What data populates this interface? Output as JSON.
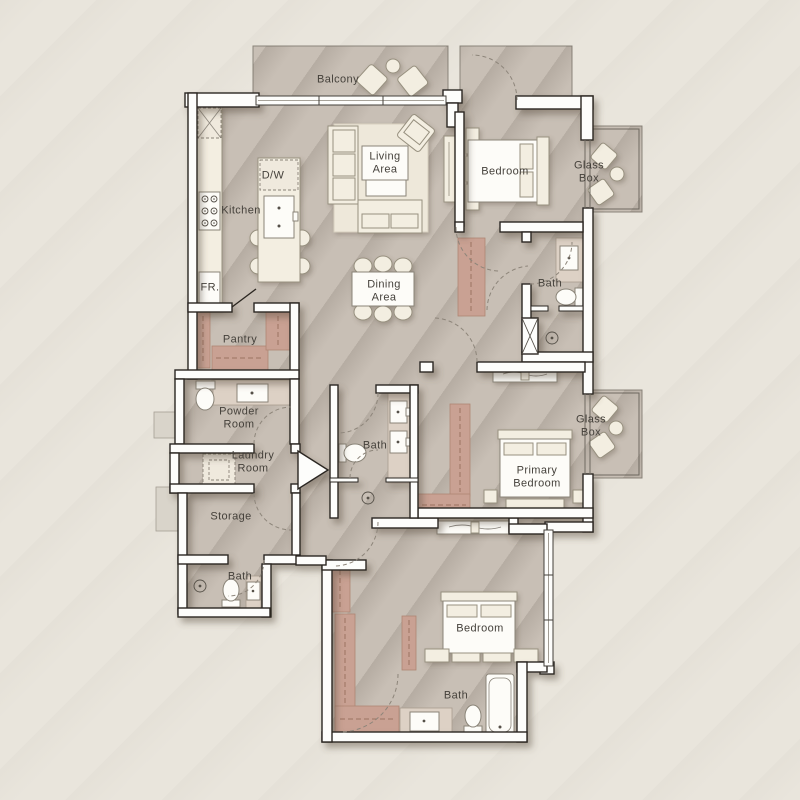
{
  "plan_type": "apartment-floor-plan",
  "rooms": {
    "balcony": "Balcony",
    "living_area": "Living Area",
    "dining_area": "Dining Area",
    "kitchen": "Kitchen",
    "dishwasher": "D/W",
    "fridge": "FR.",
    "bedroom_top": "Bedroom",
    "glass_box_top": "Glass Box",
    "bath_top": "Bath",
    "pantry": "Pantry",
    "powder_room": "Powder Room",
    "laundry_room": "Laundry Room",
    "storage": "Storage",
    "bath_left": "Bath",
    "bath_middle": "Bath",
    "primary_bedroom": "Primary Bedroom",
    "glass_box_middle": "Glass Box",
    "bedroom_bottom": "Bedroom",
    "bath_bottom": "Bath"
  },
  "fixture_icons": [
    "bed-icon",
    "sofa-icon",
    "armchair-icon",
    "dining-table-icon",
    "bathtub-icon",
    "toilet-icon",
    "sink-icon",
    "shower-drain-icon",
    "washer-icon",
    "cooktop-icon",
    "kitchen-island-icon",
    "wardrobe-icon",
    "lounge-chair-icon",
    "console-table-icon",
    "coffee-table-icon",
    "vent-shaft-icon"
  ],
  "colors": {
    "background": "#e9e5dc",
    "floor": "#c8bfb5",
    "wall_fill": "#fdfdfb",
    "wall_outline": "#2b2620",
    "furniture": "#f3eee1",
    "closet": "#c9a193",
    "counter": "#ddd1c5",
    "label_text": "#45413b"
  }
}
